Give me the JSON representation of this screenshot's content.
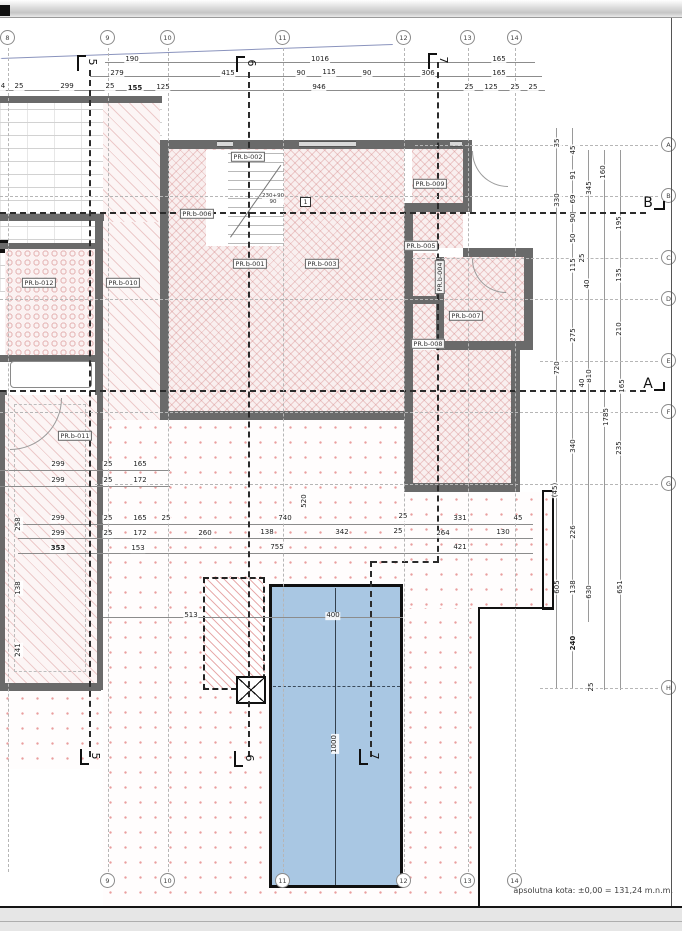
{
  "note": "apsolutna kota:  ±0,00 = 131,24 m.n.m.",
  "door_tag": {
    "line1": "230+90",
    "line2": "90",
    "box": "1"
  },
  "colors": {
    "pool_fill": "#a9c7e3",
    "hatch_pink": "#d98c8c",
    "wall_gray": "#6a6a6a",
    "roof_line_blue": "#8a93bd"
  },
  "grid": {
    "cols": [
      {
        "label": "8",
        "x": 8,
        "bottom": false
      },
      {
        "label": "9",
        "x": 108,
        "bottom": true
      },
      {
        "label": "10",
        "x": 168,
        "bottom": true
      },
      {
        "label": "11",
        "x": 283,
        "bottom": true
      },
      {
        "label": "12",
        "x": 404,
        "bottom": true
      },
      {
        "label": "13",
        "x": 468,
        "bottom": true
      },
      {
        "label": "14",
        "x": 515,
        "bottom": true
      }
    ],
    "rows": [
      {
        "label": "A",
        "y": 145,
        "x0": 415
      },
      {
        "label": "B",
        "y": 196,
        "x0": 0
      },
      {
        "label": "C",
        "y": 258,
        "x0": 412
      },
      {
        "label": "D",
        "y": 299,
        "x0": 0
      },
      {
        "label": "E",
        "y": 361,
        "x0": 540
      },
      {
        "label": "F",
        "y": 412,
        "x0": 0
      },
      {
        "label": "G",
        "y": 484,
        "x0": 95
      },
      {
        "label": "H",
        "y": 688,
        "x0": 540
      }
    ]
  },
  "sections": {
    "markers": [
      {
        "label": "5",
        "x": 90,
        "y": 63,
        "pos": "top"
      },
      {
        "label": "6",
        "x": 249,
        "y": 64,
        "pos": "top"
      },
      {
        "label": "7",
        "x": 441,
        "y": 61,
        "pos": "top"
      },
      {
        "label": "5",
        "x": 93,
        "y": 757,
        "pos": "bottom"
      },
      {
        "label": "6",
        "x": 247,
        "y": 759,
        "pos": "bottom"
      },
      {
        "label": "7",
        "x": 372,
        "y": 757,
        "pos": "bottom"
      }
    ],
    "cuts": [
      {
        "label": "B",
        "x": 648,
        "y": 203
      },
      {
        "label": "A",
        "x": 648,
        "y": 384
      }
    ]
  },
  "rooms": [
    {
      "label": "PR.b-002",
      "x": 248,
      "y": 157,
      "rot": false
    },
    {
      "label": "PR.b-009",
      "x": 430,
      "y": 184,
      "rot": false
    },
    {
      "label": "PR.b-006",
      "x": 197,
      "y": 214,
      "rot": false
    },
    {
      "label": "PR.b-005",
      "x": 421,
      "y": 246,
      "rot": false
    },
    {
      "label": "PR.b-012",
      "x": 39,
      "y": 283,
      "rot": false
    },
    {
      "label": "PR.b-010",
      "x": 123,
      "y": 283,
      "rot": false
    },
    {
      "label": "PR.b-001",
      "x": 250,
      "y": 264,
      "rot": false
    },
    {
      "label": "PR.b-003",
      "x": 322,
      "y": 264,
      "rot": false
    },
    {
      "label": "PR.b-004",
      "x": 440,
      "y": 277,
      "rot": true
    },
    {
      "label": "PR.b-007",
      "x": 466,
      "y": 316,
      "rot": false
    },
    {
      "label": "PR.b-008",
      "x": 428,
      "y": 344,
      "rot": false
    },
    {
      "label": "PR.b-011",
      "x": 75,
      "y": 436,
      "rot": false
    }
  ],
  "dims": {
    "h": [
      {
        "t": "632",
        "x": -6,
        "y": 60
      },
      {
        "t": "190",
        "x": 132,
        "y": 60
      },
      {
        "t": "1016",
        "x": 320,
        "y": 60
      },
      {
        "t": "165",
        "x": 499,
        "y": 60
      },
      {
        "t": "153",
        "x": -7,
        "y": 74
      },
      {
        "t": "279",
        "x": 117,
        "y": 74
      },
      {
        "t": "415",
        "x": 228,
        "y": 74
      },
      {
        "t": "90",
        "x": 301,
        "y": 74
      },
      {
        "t": "115",
        "x": 329,
        "y": 73
      },
      {
        "t": "90",
        "x": 367,
        "y": 74
      },
      {
        "t": "306",
        "x": 428,
        "y": 74
      },
      {
        "t": "165",
        "x": 499,
        "y": 74
      },
      {
        "t": "4",
        "x": 3,
        "y": 87
      },
      {
        "t": "25",
        "x": 19,
        "y": 87
      },
      {
        "t": "299",
        "x": 67,
        "y": 87
      },
      {
        "t": "25",
        "x": 110,
        "y": 87
      },
      {
        "t": "155",
        "x": 135,
        "y": 89,
        "b": 1
      },
      {
        "t": "125",
        "x": 163,
        "y": 88
      },
      {
        "t": "946",
        "x": 319,
        "y": 88
      },
      {
        "t": "25",
        "x": 469,
        "y": 88
      },
      {
        "t": "125",
        "x": 491,
        "y": 88
      },
      {
        "t": "25",
        "x": 515,
        "y": 88
      },
      {
        "t": "25",
        "x": 533,
        "y": 88
      },
      {
        "t": "299",
        "x": 58,
        "y": 465
      },
      {
        "t": "25",
        "x": 108,
        "y": 465
      },
      {
        "t": "165",
        "x": 140,
        "y": 465
      },
      {
        "t": "299",
        "x": 58,
        "y": 481
      },
      {
        "t": "25",
        "x": 108,
        "y": 481
      },
      {
        "t": "172",
        "x": 140,
        "y": 481
      },
      {
        "t": "299",
        "x": 58,
        "y": 519
      },
      {
        "t": "25",
        "x": 108,
        "y": 519
      },
      {
        "t": "165",
        "x": 140,
        "y": 519
      },
      {
        "t": "25",
        "x": 166,
        "y": 519
      },
      {
        "t": "299",
        "x": 58,
        "y": 534
      },
      {
        "t": "25",
        "x": 108,
        "y": 534
      },
      {
        "t": "172",
        "x": 140,
        "y": 534
      },
      {
        "t": "260",
        "x": 205,
        "y": 534
      },
      {
        "t": "353",
        "x": 58,
        "y": 549,
        "b": 1
      },
      {
        "t": "153",
        "x": 138,
        "y": 549
      },
      {
        "t": "740",
        "x": 285,
        "y": 519
      },
      {
        "t": "25",
        "x": 403,
        "y": 517
      },
      {
        "t": "331",
        "x": 460,
        "y": 519
      },
      {
        "t": "45",
        "x": 518,
        "y": 519
      },
      {
        "t": "138",
        "x": 267,
        "y": 533
      },
      {
        "t": "342",
        "x": 342,
        "y": 533
      },
      {
        "t": "25",
        "x": 398,
        "y": 532
      },
      {
        "t": "264",
        "x": 443,
        "y": 534
      },
      {
        "t": "130",
        "x": 503,
        "y": 533
      },
      {
        "t": "755",
        "x": 277,
        "y": 548
      },
      {
        "t": "421",
        "x": 460,
        "y": 548
      },
      {
        "t": "513",
        "x": 191,
        "y": 616
      },
      {
        "t": "400",
        "x": 333,
        "y": 616
      }
    ],
    "v": [
      {
        "t": "258",
        "x": 19,
        "y": 524
      },
      {
        "t": "138",
        "x": 19,
        "y": 588
      },
      {
        "t": "241",
        "x": 19,
        "y": 650
      },
      {
        "t": "520",
        "x": 305,
        "y": 501
      },
      {
        "t": "1000",
        "x": 335,
        "y": 744
      },
      {
        "t": "35",
        "x": 558,
        "y": 143
      },
      {
        "t": "45",
        "x": 574,
        "y": 150
      },
      {
        "t": "91",
        "x": 574,
        "y": 175
      },
      {
        "t": "160",
        "x": 604,
        "y": 172
      },
      {
        "t": "330",
        "x": 558,
        "y": 200
      },
      {
        "t": "69",
        "x": 574,
        "y": 199
      },
      {
        "t": "345",
        "x": 590,
        "y": 188
      },
      {
        "t": "90",
        "x": 574,
        "y": 218
      },
      {
        "t": "195",
        "x": 620,
        "y": 223
      },
      {
        "t": "50",
        "x": 574,
        "y": 238
      },
      {
        "t": "25",
        "x": 583,
        "y": 258
      },
      {
        "t": "115",
        "x": 574,
        "y": 265
      },
      {
        "t": "135",
        "x": 620,
        "y": 275
      },
      {
        "t": "40",
        "x": 588,
        "y": 284
      },
      {
        "t": "275",
        "x": 574,
        "y": 335
      },
      {
        "t": "210",
        "x": 620,
        "y": 329
      },
      {
        "t": "720",
        "x": 558,
        "y": 368
      },
      {
        "t": "810",
        "x": 590,
        "y": 376
      },
      {
        "t": "40",
        "x": 583,
        "y": 383
      },
      {
        "t": "165",
        "x": 623,
        "y": 386
      },
      {
        "t": "1785",
        "x": 607,
        "y": 417
      },
      {
        "t": "340",
        "x": 574,
        "y": 446
      },
      {
        "t": "235",
        "x": 620,
        "y": 448
      },
      {
        "t": "(45)",
        "x": 556,
        "y": 490
      },
      {
        "t": "226",
        "x": 574,
        "y": 532
      },
      {
        "t": "605",
        "x": 558,
        "y": 587
      },
      {
        "t": "138",
        "x": 574,
        "y": 587
      },
      {
        "t": "630",
        "x": 590,
        "y": 592
      },
      {
        "t": "651",
        "x": 621,
        "y": 587
      },
      {
        "t": "240",
        "x": 574,
        "y": 643,
        "b": 1
      },
      {
        "t": "25",
        "x": 592,
        "y": 687
      }
    ]
  }
}
